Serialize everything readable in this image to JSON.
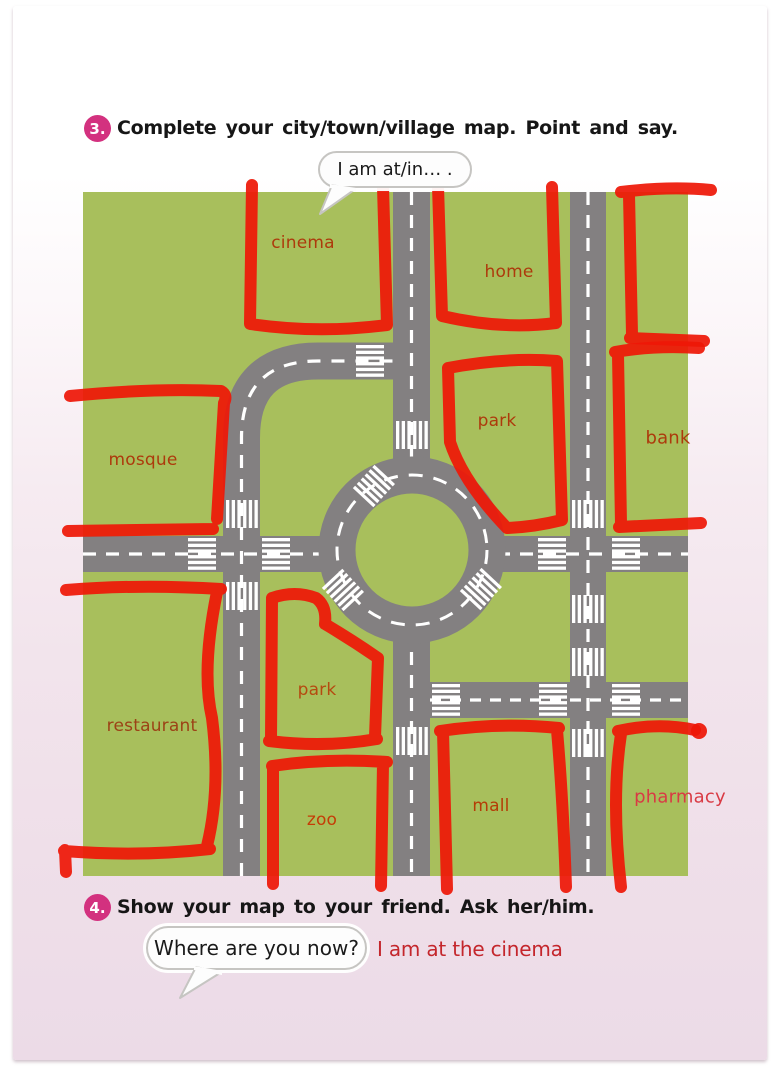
{
  "exercise3": {
    "badge": "3.",
    "instruction": "Complete your city/town/village map. Point and say.",
    "bubble": "I am at/in… ."
  },
  "exercise4": {
    "badge": "4.",
    "instruction": "Show your map to your friend. Ask her/him.",
    "bubble": "Where are you now?",
    "answer": "I am at the cinema"
  },
  "map": {
    "labels": [
      {
        "id": "cinema",
        "text": "cinema",
        "x": 303,
        "y": 243,
        "color": "#ad3a0c",
        "size": 17
      },
      {
        "id": "home",
        "text": "home",
        "x": 509,
        "y": 272,
        "color": "#ad3a0c",
        "size": 17
      },
      {
        "id": "park-north",
        "text": "park",
        "x": 497,
        "y": 421,
        "color": "#ad3a0c",
        "size": 17
      },
      {
        "id": "bank",
        "text": "bank",
        "x": 668,
        "y": 438,
        "color": "#ad3a0c",
        "size": 18
      },
      {
        "id": "mosque",
        "text": "mosque",
        "x": 143,
        "y": 460,
        "color": "#ad3a0c",
        "size": 17
      },
      {
        "id": "restaurant",
        "text": "restaurant",
        "x": 152,
        "y": 726,
        "color": "#9c4216",
        "size": 17
      },
      {
        "id": "park-south",
        "text": "park",
        "x": 317,
        "y": 690,
        "color": "#b54a10",
        "size": 17
      },
      {
        "id": "zoo",
        "text": "zoo",
        "x": 322,
        "y": 820,
        "color": "#c53c06",
        "size": 17
      },
      {
        "id": "mall",
        "text": "mall",
        "x": 491,
        "y": 806,
        "color": "#b53c06",
        "size": 17
      },
      {
        "id": "pharmacy",
        "text": "pharmacy",
        "x": 680,
        "y": 797,
        "color": "#d93a44",
        "size": 18
      }
    ],
    "colors": {
      "grass": "#a8bf5c",
      "road": "#838081",
      "marking": "#ffffff",
      "annotation": "#ee1807"
    }
  },
  "accent": {
    "badge_color": "#d3317f",
    "answer_color": "#c4262c"
  }
}
